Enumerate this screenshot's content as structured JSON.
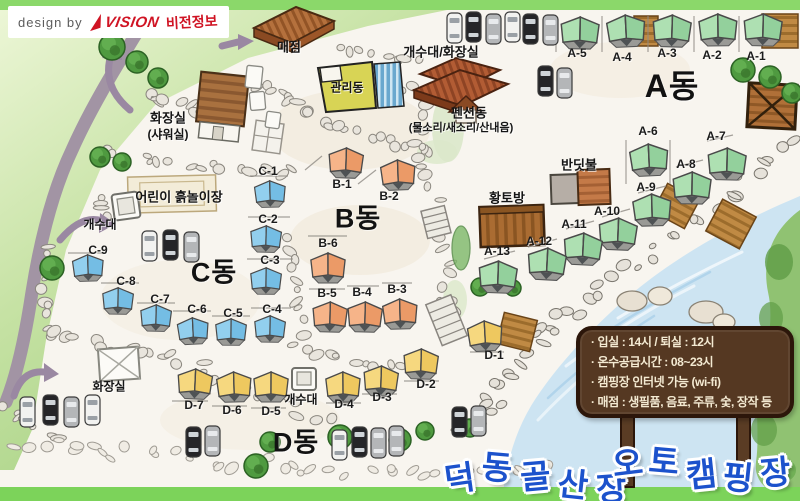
{
  "credit": {
    "prefix": "design by",
    "brand": "VISION",
    "brand_kr": "비전정보"
  },
  "title": {
    "words": [
      "덕동골산장",
      "오토캠핑장"
    ],
    "color": "#1c52cc"
  },
  "info_sign": {
    "lines": [
      "· 입실 : 14시  / 퇴실 : 12시",
      "· 온수공급시간 : 08~23시",
      "· 캠핑장 인터넷 가능 (wi-fi)",
      "· 매점 : 생필품, 음료, 주류, 숯, 장작 등"
    ],
    "board_color": "#553822"
  },
  "zones": [
    {
      "id": "A",
      "label": "A동",
      "x": 672,
      "y": 84,
      "size": 32
    },
    {
      "id": "B",
      "label": "B동",
      "x": 358,
      "y": 216,
      "size": 27
    },
    {
      "id": "C",
      "label": "C동",
      "x": 214,
      "y": 270,
      "size": 27
    },
    {
      "id": "D",
      "label": "D동",
      "x": 296,
      "y": 440,
      "size": 27
    }
  ],
  "tents": [
    {
      "zone": "A",
      "label": "A-1",
      "x": 742,
      "y": 12,
      "lx": 756,
      "ly": 56
    },
    {
      "zone": "A",
      "label": "A-2",
      "x": 697,
      "y": 12,
      "lx": 712,
      "ly": 55
    },
    {
      "zone": "A",
      "label": "A-3",
      "x": 651,
      "y": 13,
      "lx": 667,
      "ly": 53
    },
    {
      "zone": "A",
      "label": "A-4",
      "x": 605,
      "y": 13,
      "lx": 622,
      "ly": 57
    },
    {
      "zone": "A",
      "label": "A-5",
      "x": 559,
      "y": 15,
      "lx": 577,
      "ly": 53
    },
    {
      "zone": "A",
      "label": "A-6",
      "x": 628,
      "y": 142,
      "lx": 648,
      "ly": 131
    },
    {
      "zone": "A",
      "label": "A-7",
      "x": 706,
      "y": 146,
      "lx": 716,
      "ly": 136
    },
    {
      "zone": "A",
      "label": "A-8",
      "x": 671,
      "y": 170,
      "lx": 686,
      "ly": 164
    },
    {
      "zone": "A",
      "label": "A-9",
      "x": 631,
      "y": 192,
      "lx": 646,
      "ly": 187
    },
    {
      "zone": "A",
      "label": "A-10",
      "x": 597,
      "y": 216,
      "lx": 607,
      "ly": 211
    },
    {
      "zone": "A",
      "label": "A-11",
      "x": 562,
      "y": 231,
      "lx": 574,
      "ly": 224
    },
    {
      "zone": "A",
      "label": "A-12",
      "x": 526,
      "y": 246,
      "lx": 539,
      "ly": 241
    },
    {
      "zone": "A",
      "label": "A-13",
      "x": 477,
      "y": 259,
      "lx": 497,
      "ly": 251
    },
    {
      "zone": "B",
      "label": "B-1",
      "x": 327,
      "y": 146,
      "lx": 342,
      "ly": 184
    },
    {
      "zone": "B",
      "label": "B-2",
      "x": 379,
      "y": 158,
      "lx": 389,
      "ly": 196
    },
    {
      "zone": "B",
      "label": "B-3",
      "x": 381,
      "y": 297,
      "lx": 397,
      "ly": 289
    },
    {
      "zone": "B",
      "label": "B-4",
      "x": 346,
      "y": 300,
      "lx": 362,
      "ly": 292
    },
    {
      "zone": "B",
      "label": "B-5",
      "x": 311,
      "y": 300,
      "lx": 327,
      "ly": 293
    },
    {
      "zone": "B",
      "label": "B-6",
      "x": 309,
      "y": 251,
      "lx": 328,
      "ly": 243
    },
    {
      "zone": "C",
      "label": "C-1",
      "x": 253,
      "y": 179,
      "lx": 268,
      "ly": 171
    },
    {
      "zone": "C",
      "label": "C-2",
      "x": 249,
      "y": 224,
      "lx": 268,
      "ly": 219
    },
    {
      "zone": "C",
      "label": "C-3",
      "x": 249,
      "y": 266,
      "lx": 270,
      "ly": 260
    },
    {
      "zone": "C",
      "label": "C-4",
      "x": 253,
      "y": 314,
      "lx": 272,
      "ly": 309
    },
    {
      "zone": "C",
      "label": "C-5",
      "x": 214,
      "y": 317,
      "lx": 233,
      "ly": 313
    },
    {
      "zone": "C",
      "label": "C-6",
      "x": 176,
      "y": 316,
      "lx": 197,
      "ly": 309
    },
    {
      "zone": "C",
      "label": "C-7",
      "x": 139,
      "y": 303,
      "lx": 160,
      "ly": 299
    },
    {
      "zone": "C",
      "label": "C-8",
      "x": 101,
      "y": 286,
      "lx": 126,
      "ly": 281
    },
    {
      "zone": "C",
      "label": "C-9",
      "x": 71,
      "y": 253,
      "lx": 98,
      "ly": 250
    },
    {
      "zone": "D",
      "label": "D-1",
      "x": 466,
      "y": 319,
      "lx": 494,
      "ly": 355
    },
    {
      "zone": "D",
      "label": "D-2",
      "x": 402,
      "y": 347,
      "lx": 426,
      "ly": 384
    },
    {
      "zone": "D",
      "label": "D-3",
      "x": 362,
      "y": 364,
      "lx": 382,
      "ly": 397
    },
    {
      "zone": "D",
      "label": "D-4",
      "x": 324,
      "y": 370,
      "lx": 344,
      "ly": 404
    },
    {
      "zone": "D",
      "label": "D-5",
      "x": 252,
      "y": 370,
      "lx": 271,
      "ly": 411
    },
    {
      "zone": "D",
      "label": "D-6",
      "x": 215,
      "y": 370,
      "lx": 232,
      "ly": 410
    },
    {
      "zone": "D",
      "label": "D-7",
      "x": 176,
      "y": 367,
      "lx": 194,
      "ly": 405
    }
  ],
  "facilities": [
    {
      "id": "store",
      "label": "매점",
      "lx": 289,
      "ly": 46,
      "size": 13
    },
    {
      "id": "admin-office",
      "label": "관리동",
      "lx": 347,
      "ly": 87,
      "size": 12
    },
    {
      "id": "sink-restroom",
      "label": "개수대/화장실",
      "lx": 441,
      "ly": 51,
      "size": 13
    },
    {
      "id": "pension",
      "label": "펜션동",
      "sub": "(물소리/새소리/산내음)",
      "lx": 469,
      "ly": 112,
      "slx": 461,
      "sly": 127,
      "size": 13,
      "subsize": 11
    },
    {
      "id": "restroom-shower",
      "label": "화장실",
      "sub": "(샤워실)",
      "lx": 168,
      "ly": 117,
      "slx": 168,
      "sly": 134,
      "size": 13,
      "subsize": 12
    },
    {
      "id": "firefly-room",
      "label": "반딧불",
      "lx": 579,
      "ly": 164,
      "size": 13
    },
    {
      "id": "clay-room",
      "label": "황토방",
      "lx": 507,
      "ly": 197,
      "size": 13
    },
    {
      "id": "kids-playground",
      "label": "어린이 흙놀이장",
      "lx": 179,
      "ly": 196,
      "size": 13
    },
    {
      "id": "sink-west",
      "label": "개수대",
      "lx": 100,
      "ly": 224,
      "size": 12
    },
    {
      "id": "sink-south",
      "label": "개수대",
      "lx": 301,
      "ly": 399,
      "size": 12
    },
    {
      "id": "restroom-south",
      "label": "화장실",
      "lx": 109,
      "ly": 386,
      "size": 12
    }
  ],
  "cars": [
    {
      "x": 447,
      "y": 13,
      "color": "white"
    },
    {
      "x": 466,
      "y": 12,
      "color": "black"
    },
    {
      "x": 486,
      "y": 14,
      "color": "silver"
    },
    {
      "x": 505,
      "y": 12,
      "color": "white"
    },
    {
      "x": 523,
      "y": 14,
      "color": "black"
    },
    {
      "x": 543,
      "y": 15,
      "color": "silver"
    },
    {
      "x": 538,
      "y": 66,
      "color": "black"
    },
    {
      "x": 557,
      "y": 68,
      "color": "silver"
    },
    {
      "x": 142,
      "y": 231,
      "color": "white"
    },
    {
      "x": 163,
      "y": 230,
      "color": "black"
    },
    {
      "x": 184,
      "y": 232,
      "color": "silver"
    },
    {
      "x": 20,
      "y": 397,
      "color": "white"
    },
    {
      "x": 43,
      "y": 395,
      "color": "black"
    },
    {
      "x": 64,
      "y": 397,
      "color": "silver"
    },
    {
      "x": 85,
      "y": 395,
      "color": "white"
    },
    {
      "x": 186,
      "y": 427,
      "color": "black"
    },
    {
      "x": 205,
      "y": 426,
      "color": "silver"
    },
    {
      "x": 332,
      "y": 430,
      "color": "white"
    },
    {
      "x": 352,
      "y": 427,
      "color": "black"
    },
    {
      "x": 371,
      "y": 428,
      "color": "silver"
    },
    {
      "x": 389,
      "y": 426,
      "color": "silver"
    },
    {
      "x": 452,
      "y": 407,
      "color": "black"
    },
    {
      "x": 471,
      "y": 406,
      "color": "silver"
    }
  ],
  "colors": {
    "tent_a_light": "#aee0b2",
    "tent_a_dark": "#93d09c",
    "tent_b_light": "#f6b489",
    "tent_b_dark": "#eb9a67",
    "tent_c_light": "#92cfee",
    "tent_c_dark": "#74bde4",
    "tent_d_light": "#f6d87f",
    "tent_d_dark": "#eec85f",
    "road": "#a294a4",
    "water": "#cde4f2",
    "grass": "#a8d482",
    "logo_red": "#d01424"
  }
}
